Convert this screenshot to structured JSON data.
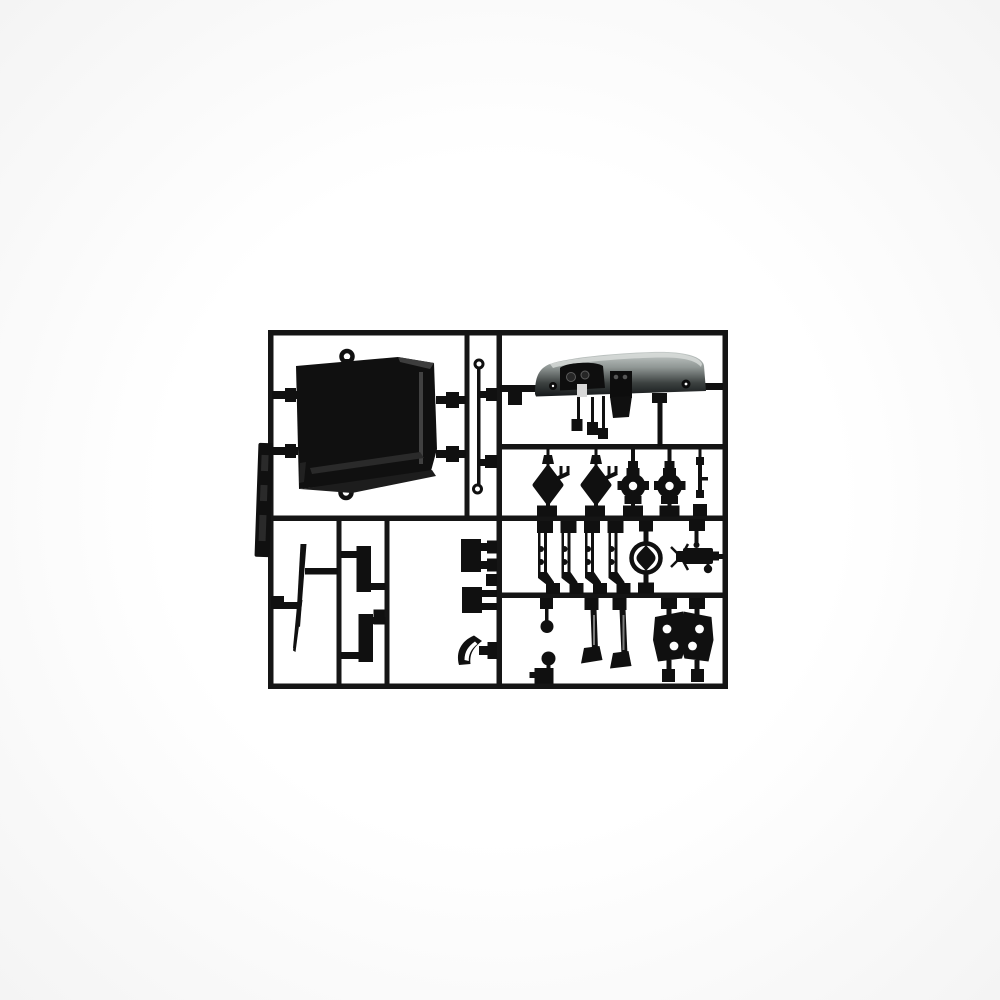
{
  "scene": {
    "description": "Product photograph of an unassembled injection-molded plastic model kit sprue (parts tree) in black plastic, centered on a plain white background. The runner frame holds car-interior parts: a large floor panel with mounting rings, a gray-shaded dashboard, hub and bracket fittings, gear levers, a steering wheel, a steering column, foot pedals, holed mounting brackets, flat plates, blocks, a scoop and wiper blades.",
    "background_color": "#fbfbfb",
    "vignette_color": "#f4f4f4",
    "plastic_color": "#101010",
    "rail_color": "#151515",
    "hole_color": "#ffffff",
    "dashboard_gradient": [
      "#c6ccca",
      "#8f9694",
      "#3c4140",
      "#15181a"
    ]
  },
  "sprue": {
    "frame_bounds": {
      "left": 268,
      "top": 330,
      "right": 728,
      "bottom": 689
    },
    "parts": [
      {
        "id": "floor-panel",
        "label": "large floor panel with two mounting rings"
      },
      {
        "id": "part-number-tag",
        "label": "molded identification tag on left rail"
      },
      {
        "id": "hooked-rod",
        "label": "thin rod with hooked ends"
      },
      {
        "id": "dashboard",
        "label": "dashboard with instrument cluster, console and hanging pedals"
      },
      {
        "id": "diamond-bracket-a",
        "label": "diamond bracket with forked arm"
      },
      {
        "id": "diamond-bracket-b",
        "label": "diamond bracket with forked arm"
      },
      {
        "id": "hub-wheel-a",
        "label": "round hub with center hole"
      },
      {
        "id": "hub-wheel-b",
        "label": "round hub with center hole"
      },
      {
        "id": "pin-part",
        "label": "small stepped pin"
      },
      {
        "id": "lever-1",
        "label": "gear lever rod"
      },
      {
        "id": "lever-2",
        "label": "gear lever rod"
      },
      {
        "id": "lever-3",
        "label": "gear lever rod"
      },
      {
        "id": "lever-4",
        "label": "gear lever rod"
      },
      {
        "id": "steering-wheel",
        "label": "steering wheel with thick hub"
      },
      {
        "id": "steering-column",
        "label": "steering column with spoked end"
      },
      {
        "id": "shift-ball-lever",
        "label": "rod with ball knob"
      },
      {
        "id": "ball-knob-block",
        "label": "ball knob on base block"
      },
      {
        "id": "pedal-a",
        "label": "foot pedal with arm"
      },
      {
        "id": "pedal-b",
        "label": "foot pedal with arm"
      },
      {
        "id": "holed-bracket-left",
        "label": "trapezoid bracket with two holes"
      },
      {
        "id": "holed-bracket-right",
        "label": "trapezoid bracket with two holes"
      },
      {
        "id": "block-a",
        "label": "rectangular block"
      },
      {
        "id": "block-b",
        "label": "rectangular block"
      },
      {
        "id": "small-square",
        "label": "small square fitting"
      },
      {
        "id": "air-scoop",
        "label": "curved scoop"
      },
      {
        "id": "flat-plate-a",
        "label": "flat vertical plate"
      },
      {
        "id": "flat-plate-b",
        "label": "flat vertical plate"
      },
      {
        "id": "wiper-blades",
        "label": "thin wiper blades"
      }
    ]
  }
}
